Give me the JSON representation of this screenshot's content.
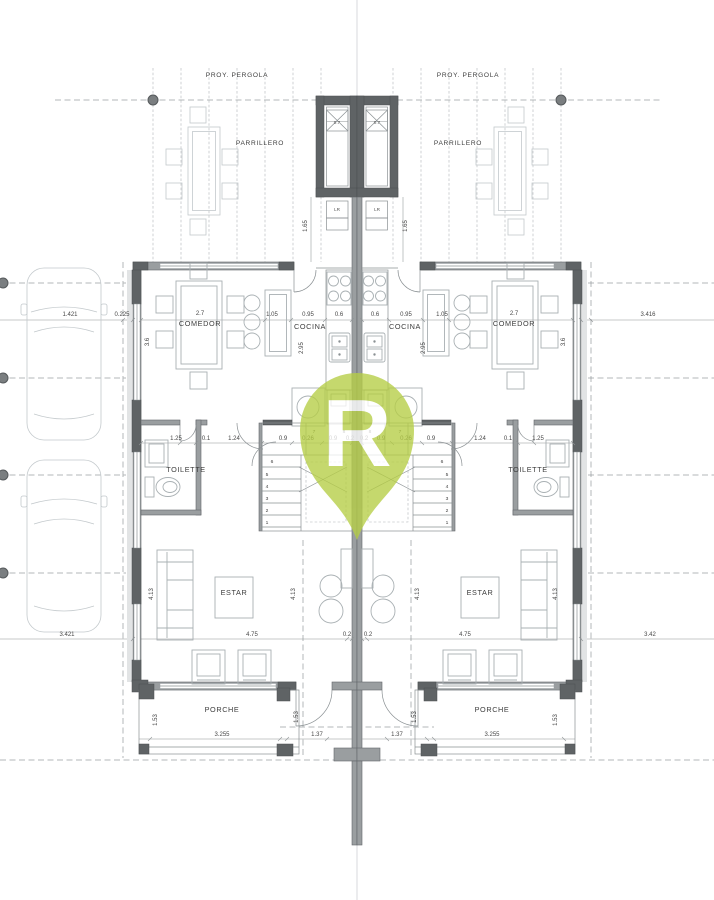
{
  "labels": {
    "proy_pergola": "PROY. PERGOLA",
    "parrillero": "PARRILLERO",
    "comedor": "COMEDOR",
    "cocina": "COCINA",
    "toilette": "TOILETTE",
    "estar": "ESTAR",
    "porche": "PORCHE",
    "lr": "LR"
  },
  "dims": {
    "lot_left_top": "1.421",
    "setback_left": "0.225",
    "lot_right_top": "3.416",
    "lot_left_bottom": "3.421",
    "lot_right_bottom": "3.42",
    "comedor_width": "2.7",
    "comedor_depth": "3.6",
    "pasillo": "1.05",
    "island": "0.95",
    "counter": "0.6",
    "kitchen_depth": "2.95",
    "grill": "0.7",
    "laundry_depth": "1.65",
    "hall_a": "1.25",
    "hall_b": "0.1",
    "hall_c": "1.24",
    "hall_d": "0.9",
    "hall_e": "0.26",
    "hall_f": "0.2",
    "estar_width": "4.75",
    "estar_depth": "4.13",
    "porche_width": "3.255",
    "porche_depth": "1.53",
    "door": "1.37"
  },
  "stairs": {
    "s1": "1",
    "s2": "2",
    "s3": "3",
    "s4": "4",
    "s5": "5",
    "s6": "6",
    "s7": "7",
    "s8": "8"
  },
  "watermark": {
    "letter": "R",
    "color": "#b6ce45"
  },
  "colors": {
    "wall": "#9a9ea0",
    "wall_dark": "#5f6365",
    "watermark": "#b6ce45"
  }
}
